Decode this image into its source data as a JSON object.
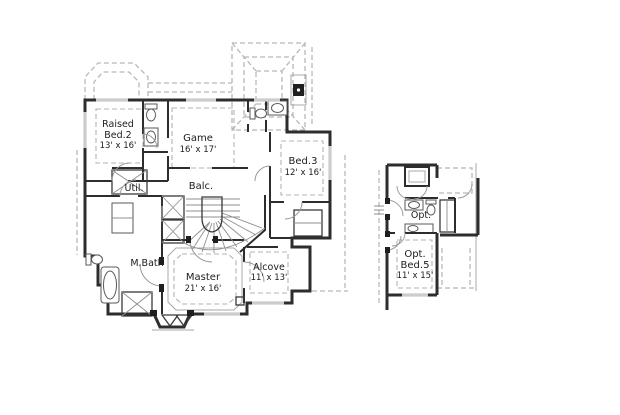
{
  "floor_plan": {
    "colors": {
      "background": "#ffffff",
      "walls": "#2d2d2d",
      "roof_dashes": "#b8b8b8",
      "text": "#1c1c1c"
    },
    "rooms": {
      "raised_bed2": {
        "line1": "Raised",
        "line2": "Bed.2",
        "dims": "13' x 16'"
      },
      "game": {
        "name": "Game",
        "dims": "16' x 17'"
      },
      "bed3": {
        "name": "Bed.3",
        "dims": "12' x 16'"
      },
      "util": {
        "name": "Util."
      },
      "balcony": {
        "name": "Balc."
      },
      "master_bath": {
        "name": "M.Bath"
      },
      "master": {
        "name": "Master",
        "dims": "21' x 16'"
      },
      "alcove": {
        "name": "Alcove",
        "dims": "11' x 13'"
      },
      "opt_bath": {
        "name": "Opt."
      },
      "opt_bed5": {
        "line1": "Opt.",
        "line2": "Bed.5",
        "dims": "11' x 15'"
      }
    }
  }
}
